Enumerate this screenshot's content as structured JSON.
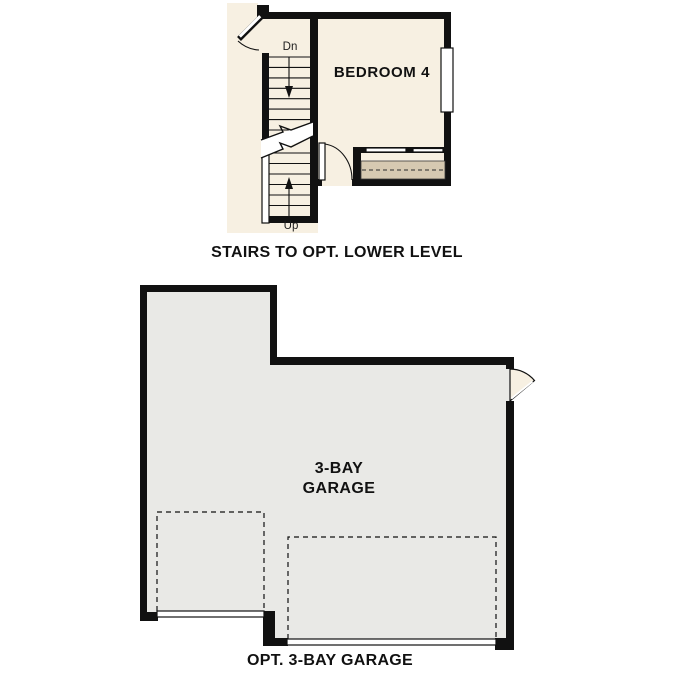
{
  "colors": {
    "wall": "#111111",
    "interior_cream": "#f7f0e2",
    "garage_gray": "#e9e9e6",
    "closet_shelf_tan": "#d6c9b1",
    "text": "#111111"
  },
  "upper_plan": {
    "caption": "STAIRS TO OPT. LOWER LEVEL",
    "bedroom_label": "BEDROOM 4",
    "stairs_down_label": "Dn",
    "stairs_up_label": "Up"
  },
  "garage_plan": {
    "caption": "OPT. 3-BAY GARAGE",
    "label_line1": "3-BAY",
    "label_line2": "GARAGE"
  }
}
